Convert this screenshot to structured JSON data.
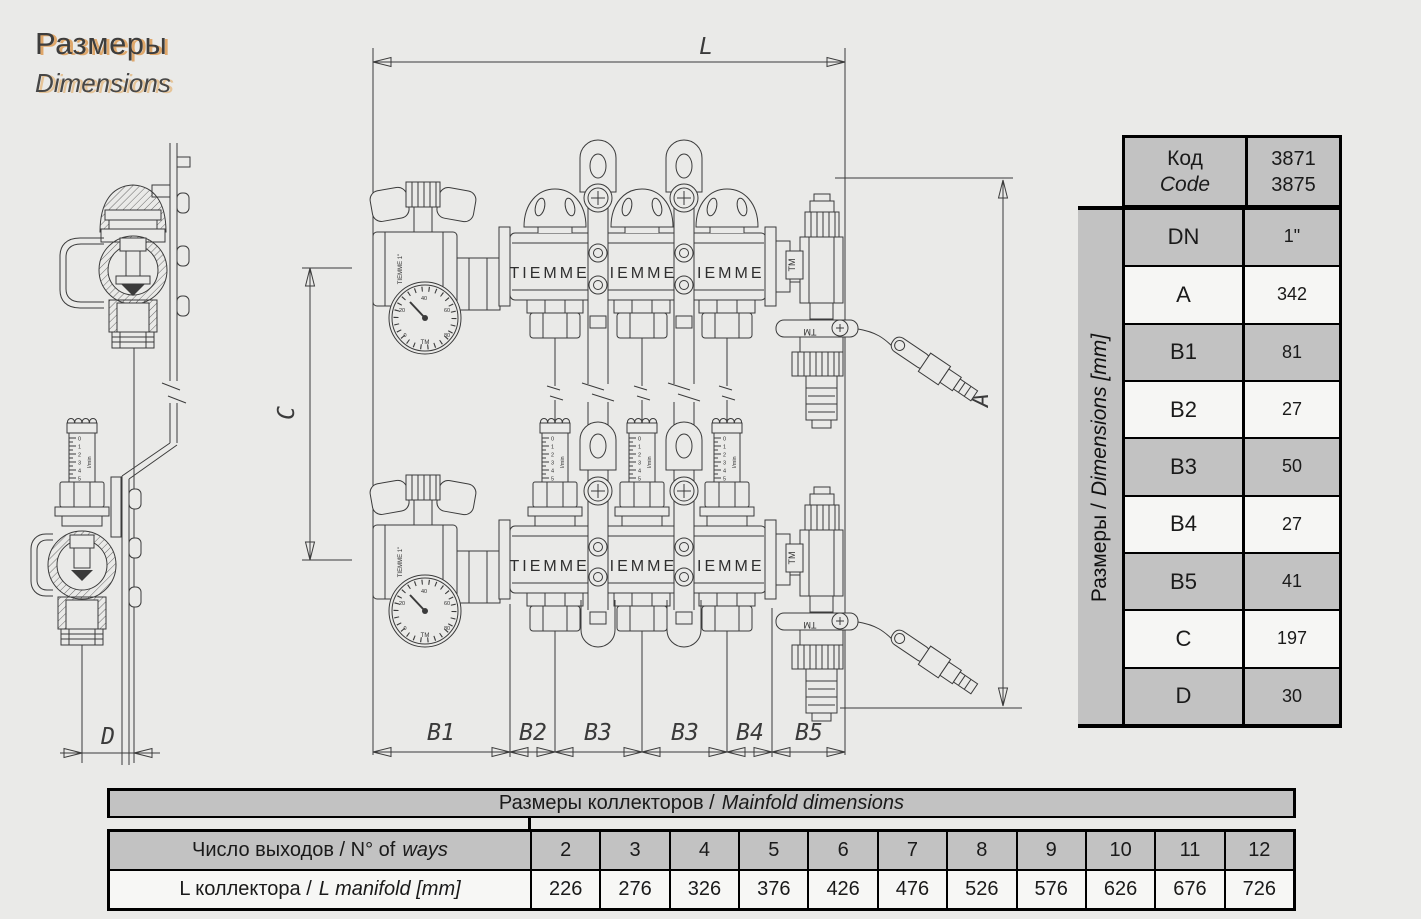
{
  "header": {
    "title_ru": "Размеры",
    "title_en": "Dimensions"
  },
  "spec_table": {
    "code_label_ru": "Код",
    "code_label_en": "Code",
    "code_values": [
      "3871",
      "3875"
    ],
    "side_label_ru": "Размеры /",
    "side_label_en": "Dimensions [mm]",
    "rows": [
      {
        "param": "DN",
        "value": "1\""
      },
      {
        "param": "A",
        "value": "342"
      },
      {
        "param": "B1",
        "value": "81"
      },
      {
        "param": "B2",
        "value": "27"
      },
      {
        "param": "B3",
        "value": "50"
      },
      {
        "param": "B4",
        "value": "27"
      },
      {
        "param": "B5",
        "value": "41"
      },
      {
        "param": "C",
        "value": "197"
      },
      {
        "param": "D",
        "value": "30"
      }
    ]
  },
  "manifold_table": {
    "title_ru": "Размеры коллекторов /",
    "title_en": "Mainfold dimensions",
    "ways_label_ru": "Число выходов / N° of",
    "ways_label_en": "ways",
    "length_label_ru": "L коллектора  /",
    "length_label_en": "L manifold [mm]",
    "ways": [
      "2",
      "3",
      "4",
      "5",
      "6",
      "7",
      "8",
      "9",
      "10",
      "11",
      "12"
    ],
    "lengths": [
      "226",
      "276",
      "326",
      "376",
      "426",
      "476",
      "526",
      "576",
      "626",
      "676",
      "726"
    ]
  },
  "drawing": {
    "dim_labels": {
      "L": "L",
      "A": "A",
      "C": "C",
      "D": "D",
      "B1": "B1",
      "B2": "B2",
      "B3_left": "B3",
      "B3_right": "B3",
      "B4": "B4",
      "B5": "B5"
    },
    "brand_text": "TIEMME  TIEMME  TIEMME",
    "valve_label": "TIEMME 1\"",
    "tm_label": "TM",
    "gauge_scale": [
      "0",
      "20",
      "40",
      "60",
      "80"
    ],
    "flow_scale": [
      "0",
      "1",
      "2",
      "3",
      "4",
      "5"
    ],
    "flow_unit": "l/min"
  },
  "colors": {
    "background": "#eaeae8",
    "table_gray": "#c2c2c2",
    "row_light": "#f6f6f4",
    "title_shadow": "#de9f5c",
    "line": "#3b3b3b"
  }
}
